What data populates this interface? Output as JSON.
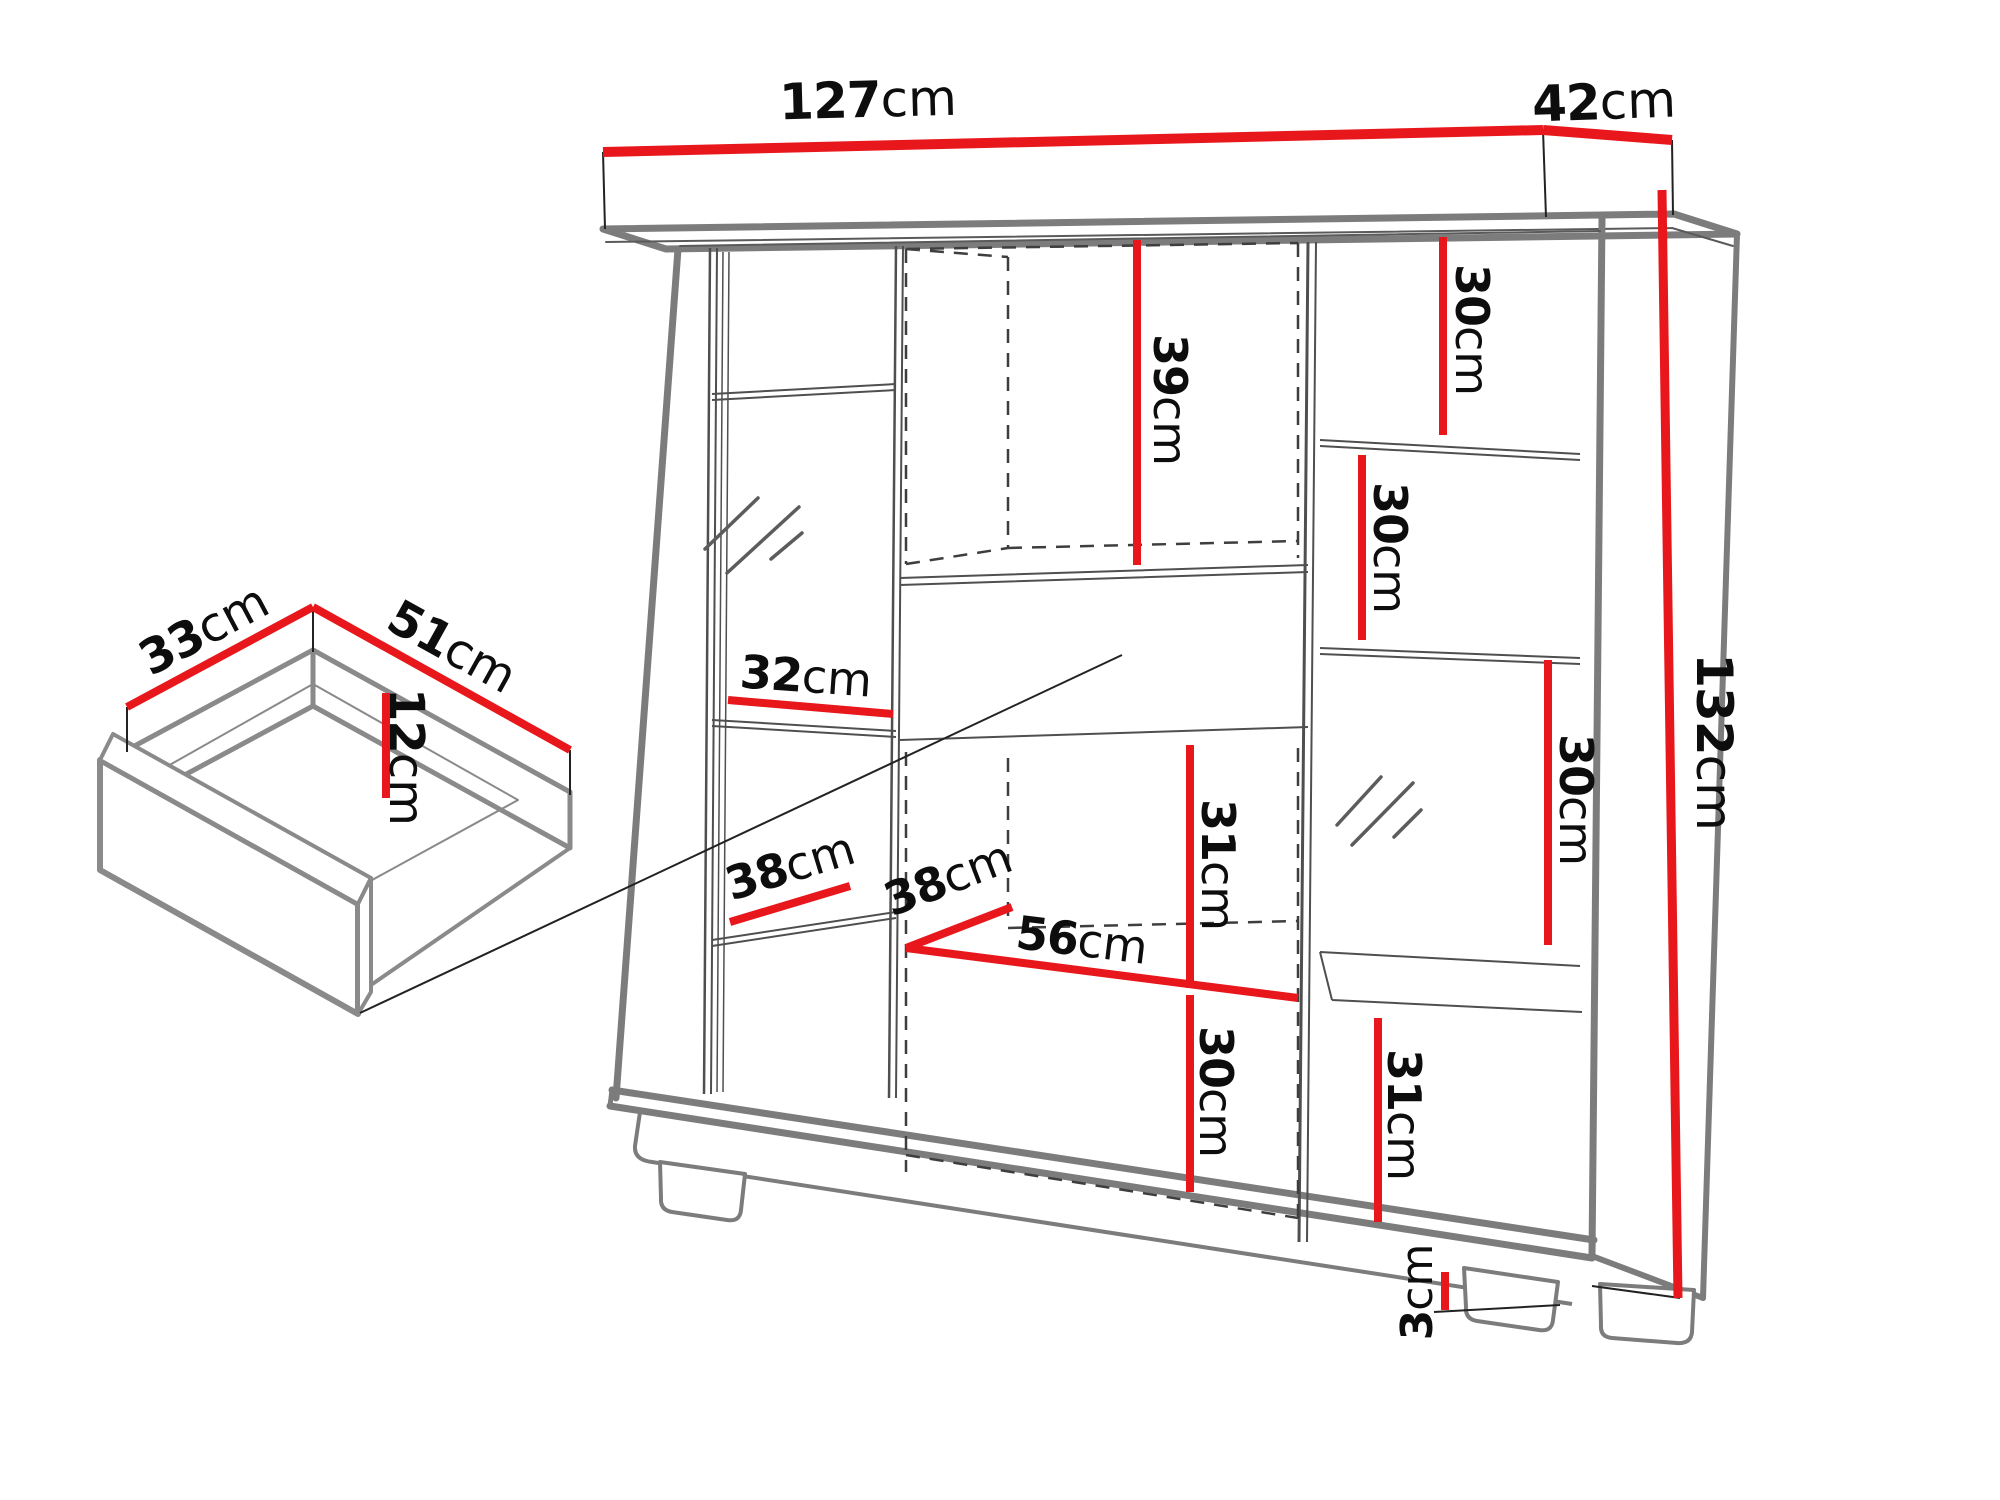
{
  "diagram_type": "furniture-dimension-drawing",
  "colors": {
    "dimension_red": "#e8171c",
    "outline_gray": "#7c7c7c",
    "thin_line_gray": "#4f4f4f",
    "text_black": "#0d0d0d",
    "background": "#ffffff"
  },
  "cabinet": {
    "overall": {
      "width": "127cm",
      "depth": "42cm",
      "height": "132cm",
      "foot_height": "3cm"
    },
    "internal_dimensions": [
      "39cm",
      "30cm",
      "30cm",
      "30cm",
      "31cm",
      "32cm",
      "38cm",
      "38cm",
      "56cm",
      "31cm",
      "30cm"
    ],
    "drawer": {
      "depth": "33cm",
      "width": "51cm",
      "height": "12cm"
    }
  },
  "labels": [
    {
      "id": "cabinet-width",
      "num": "127",
      "unit": "cm"
    },
    {
      "id": "cabinet-depth",
      "num": "42",
      "unit": "cm"
    },
    {
      "id": "cabinet-height",
      "num": "132",
      "unit": "cm"
    },
    {
      "id": "top-middle-compartment-height",
      "num": "39",
      "unit": "cm"
    },
    {
      "id": "right-shelf-1-height",
      "num": "30",
      "unit": "cm"
    },
    {
      "id": "right-shelf-2-height",
      "num": "30",
      "unit": "cm"
    },
    {
      "id": "right-shelf-3-height",
      "num": "30",
      "unit": "cm"
    },
    {
      "id": "right-bottom-height",
      "num": "31",
      "unit": "cm"
    },
    {
      "id": "middle-compartment-height",
      "num": "31",
      "unit": "cm"
    },
    {
      "id": "middle-bottom-height",
      "num": "30",
      "unit": "cm"
    },
    {
      "id": "left-shelf-width",
      "num": "32",
      "unit": "cm"
    },
    {
      "id": "left-shelf-depth",
      "num": "38",
      "unit": "cm"
    },
    {
      "id": "middle-shelf-depth",
      "num": "38",
      "unit": "cm"
    },
    {
      "id": "middle-shelf-width",
      "num": "56",
      "unit": "cm"
    },
    {
      "id": "foot-height",
      "num": "3",
      "unit": "cm"
    },
    {
      "id": "drawer-depth",
      "num": "33",
      "unit": "cm"
    },
    {
      "id": "drawer-width",
      "num": "51",
      "unit": "cm"
    },
    {
      "id": "drawer-height",
      "num": "12",
      "unit": "cm"
    }
  ]
}
